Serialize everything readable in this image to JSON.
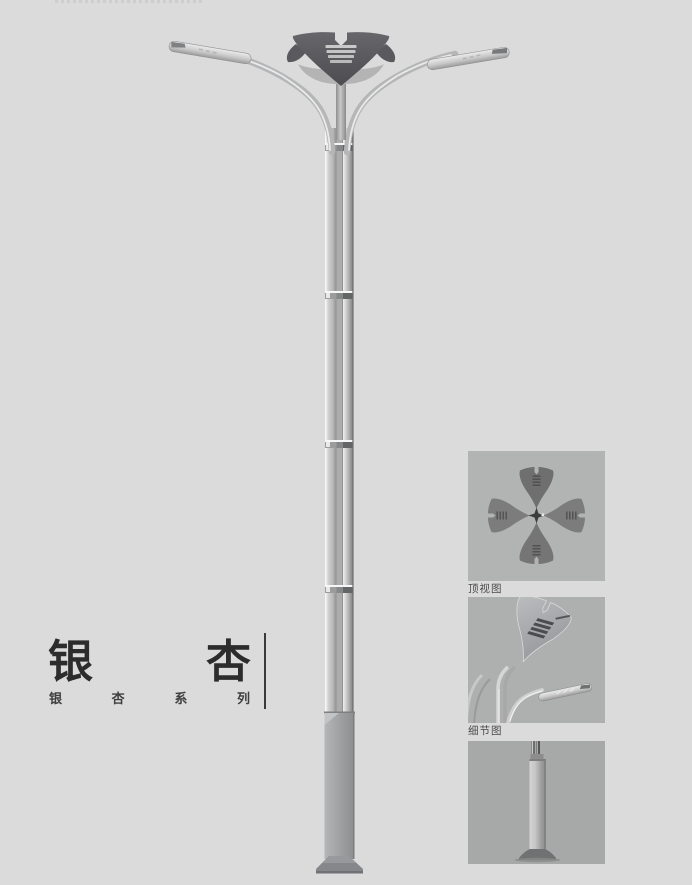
{
  "title_block": {
    "title_text": "银杏",
    "title_char_left": "银",
    "title_char_right": "杏",
    "subtitle_text": "银杏系列",
    "subtitle_chars": [
      "银",
      "杏",
      "系",
      "列"
    ]
  },
  "detail_panels": [
    {
      "id": "top-view",
      "caption": "顶视图"
    },
    {
      "id": "detail-view",
      "caption": "细节图"
    },
    {
      "id": "base-view",
      "caption": ""
    }
  ],
  "colors": {
    "page_background": "#dbdbdb",
    "panel_background": "#b0b1b1",
    "lamp_crown_dark": "#57575a",
    "pole_silver": "#c5c5c5",
    "pole_base_gray": "#9a9c9e",
    "title_text": "#2c2c2c",
    "caption_text": "#4a4a4a"
  }
}
